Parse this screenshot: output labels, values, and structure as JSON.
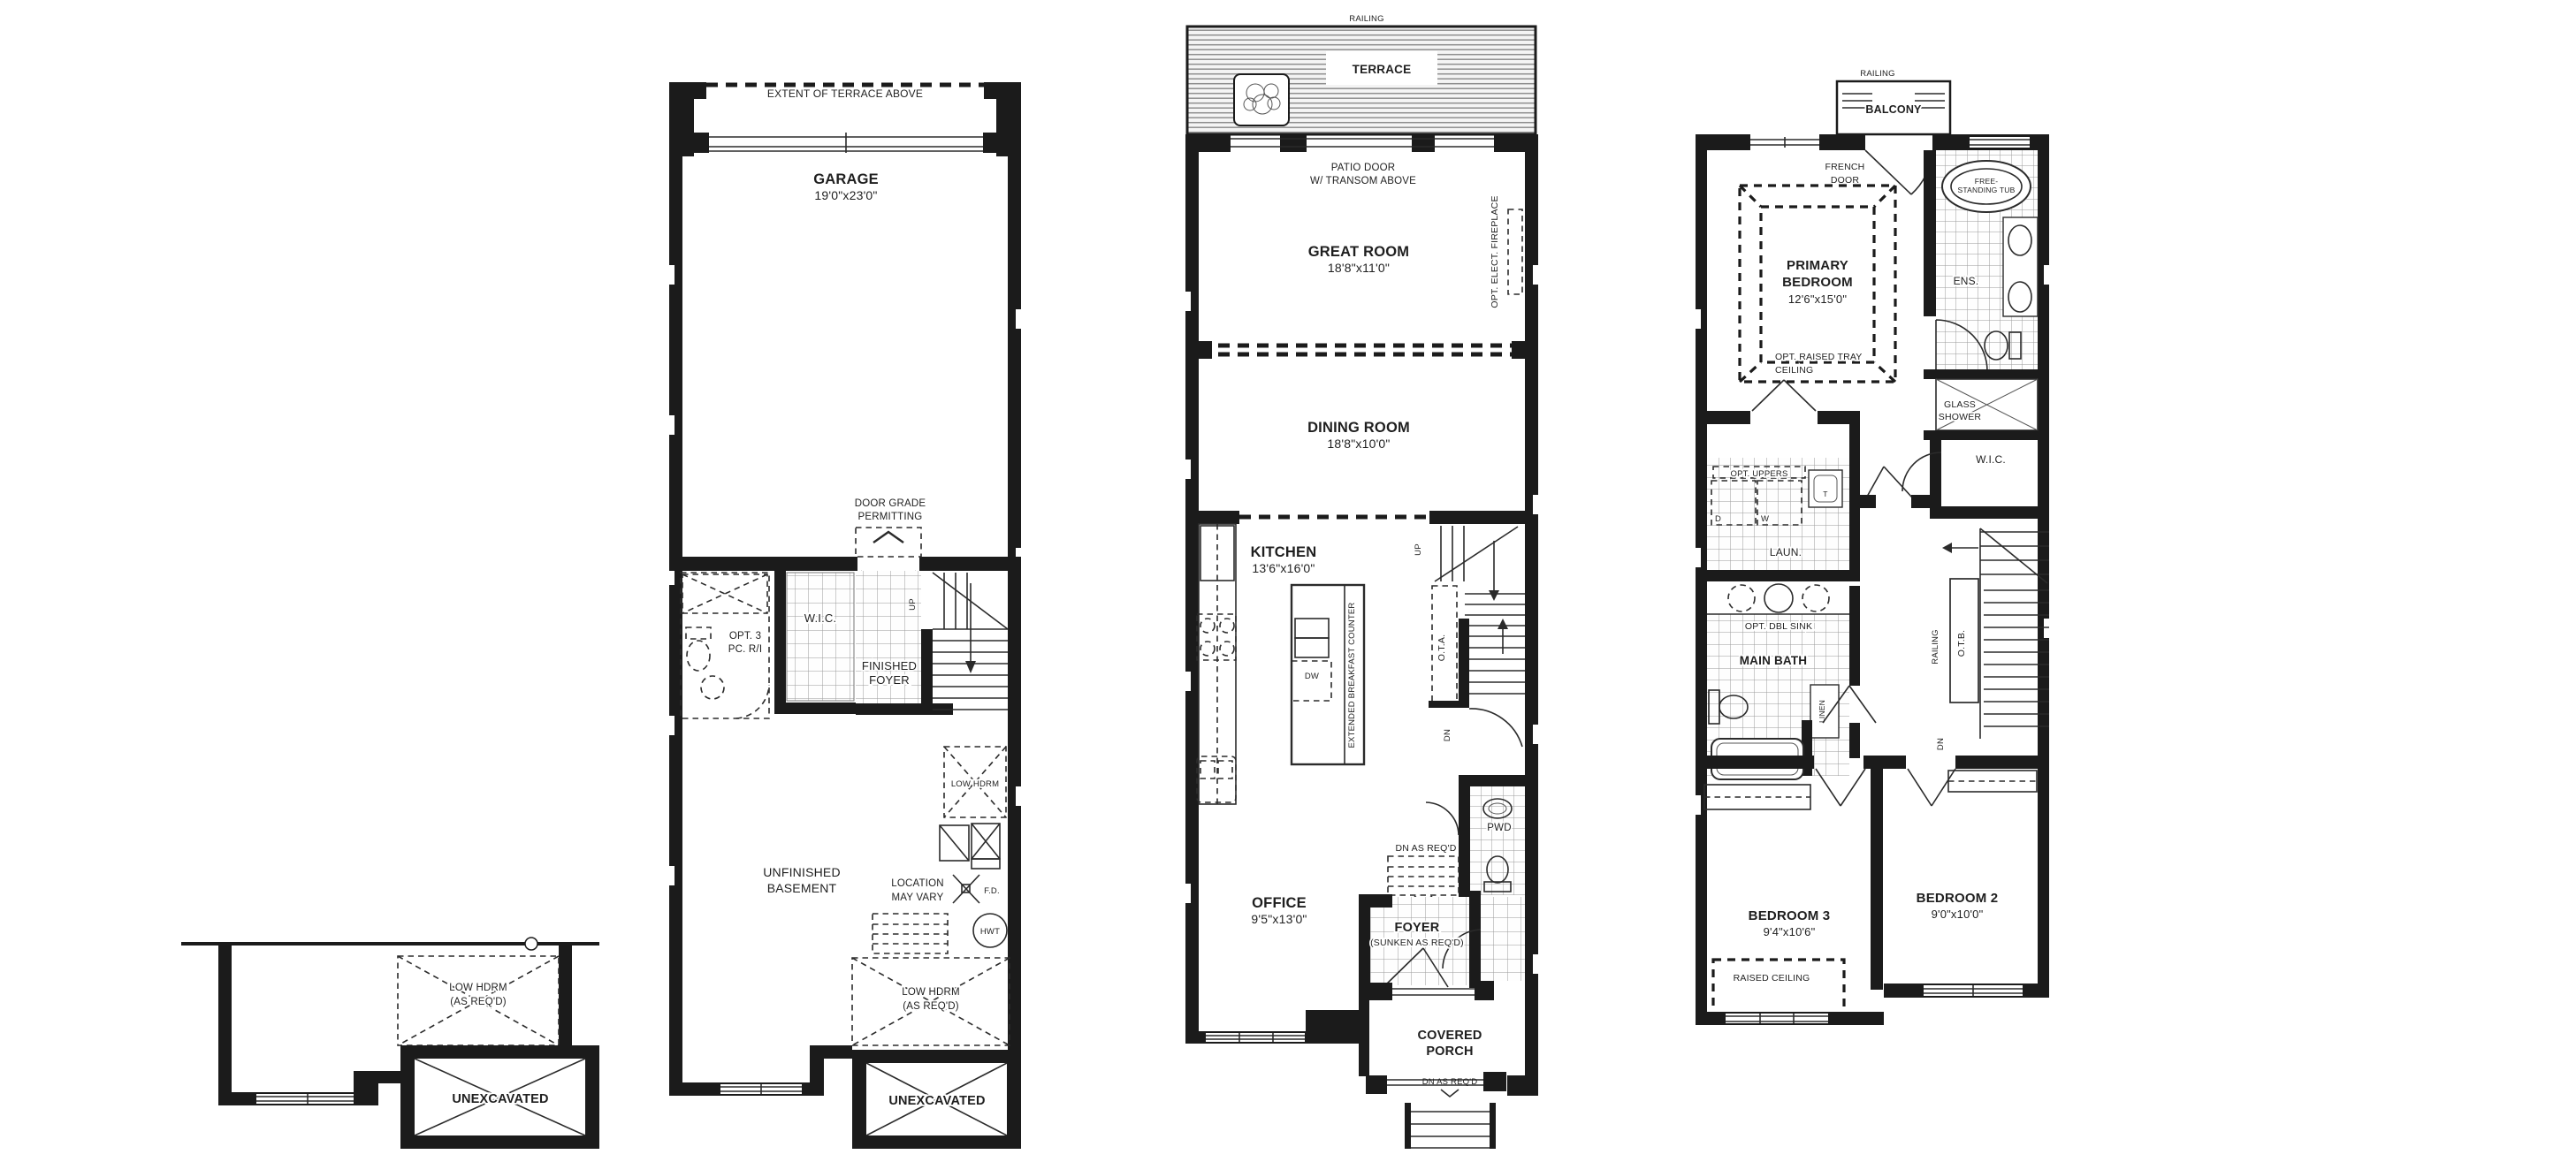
{
  "meta": {
    "background": "#ffffff",
    "ink": "#1b1b1b",
    "drawing_type": "townhome architectural floor plans (4 sheets: partial foundation, ground floor with garage and basement, main floor, second floor)"
  },
  "foundation": {
    "low_hdrm": [
      "LOW HDRM",
      "(AS REQ'D)"
    ],
    "unexcavated": "UNEXCAVATED"
  },
  "ground": {
    "extent": "EXTENT OF TERRACE ABOVE",
    "garage": "GARAGE",
    "garage_dim": "19'0\"x23'0\"",
    "door_grade": [
      "DOOR GRADE",
      "PERMITTING"
    ],
    "wic": "W.I.C.",
    "opt_bath": [
      "OPT. 3",
      "PC. R/I"
    ],
    "finished_foyer": [
      "FINISHED",
      "FOYER"
    ],
    "up": "UP",
    "unfinished": [
      "UNFINISHED",
      "BASEMENT"
    ],
    "low_hdrm": "LOW HDRM",
    "location": [
      "LOCATION",
      "MAY VARY"
    ],
    "fd": "F.D.",
    "hwt": "HWT",
    "low_hdrm_req": [
      "LOW HDRM",
      "(AS REQ'D)"
    ],
    "unexcavated": "UNEXCAVATED"
  },
  "main": {
    "railing": "RAILING",
    "terrace": "TERRACE",
    "patio_door": [
      "PATIO DOOR",
      "W/ TRANSOM ABOVE"
    ],
    "great_room": "GREAT ROOM",
    "great_room_dim": "18'8\"x11'0\"",
    "fireplace": "OPT. ELECT. FIREPLACE",
    "dining_room": "DINING ROOM",
    "dining_room_dim": "18'8\"x10'0\"",
    "kitchen": "KITCHEN",
    "kitchen_dim": "13'6\"x16'0\"",
    "dw": "DW",
    "breakfast_counter": "EXTENDED BREAKFAST COUNTER",
    "up": "UP",
    "ota": "O.T.A.",
    "dn": "DN",
    "pwd": "PWD",
    "dn_as_reqd_upper": "DN AS REQ'D",
    "office": "OFFICE",
    "office_dim": "9'5\"x13'0\"",
    "foyer": "FOYER",
    "foyer_sub": "(SUNKEN AS REQ'D)",
    "covered_porch": [
      "COVERED",
      "PORCH"
    ],
    "dn_as_reqd_lower": "DN AS REQ'D"
  },
  "upper": {
    "railing": "RAILING",
    "balcony": "BALCONY",
    "french_door": [
      "FRENCH",
      "DOOR"
    ],
    "tub": [
      "FREE-",
      "STANDING TUB"
    ],
    "primary": [
      "PRIMARY",
      "BEDROOM"
    ],
    "primary_dim": "12'6\"x15'0\"",
    "tray": [
      "OPT. RAISED TRAY",
      "CEILING"
    ],
    "ens": "ENS.",
    "glass_shower": [
      "GLASS",
      "SHOWER"
    ],
    "wic": "W.I.C.",
    "opt_uppers": "OPT. UPPERS",
    "dryer": "D",
    "washer": "W",
    "laundry_tub": "T",
    "laundry": "LAUN.",
    "dbl_sink": "OPT. DBL SINK",
    "main_bath": "MAIN BATH",
    "linen": "LINEN",
    "railing_stair": "RAILING",
    "otb": "O.T.B.",
    "dn": "DN",
    "bedroom3": "BEDROOM 3",
    "bedroom3_dim": "9'4\"x10'6\"",
    "raised_ceiling": "RAISED CEILING",
    "bedroom2": "BEDROOM 2",
    "bedroom2_dim": "9'0\"x10'0\""
  }
}
